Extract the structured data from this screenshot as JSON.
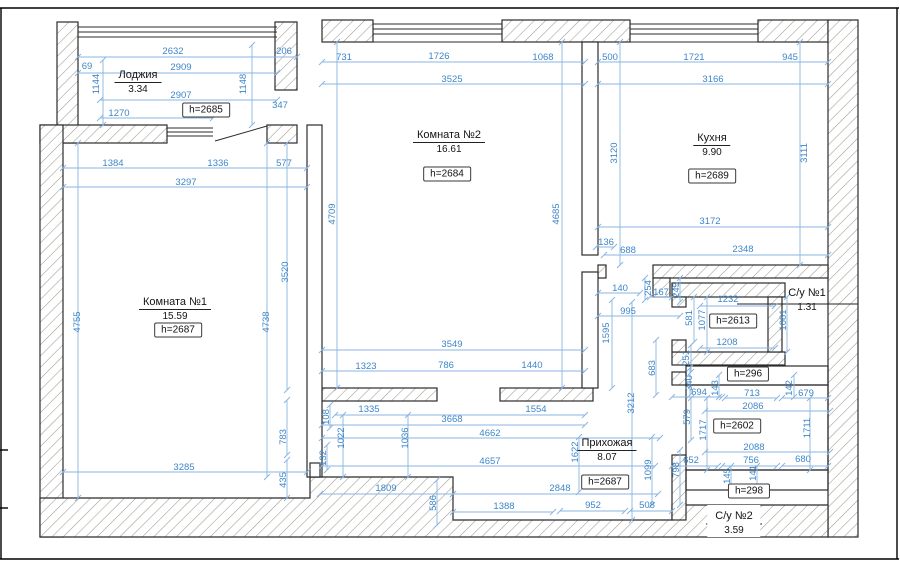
{
  "colors": {
    "dimension_text": "#3e86c8",
    "dimension_line": "#8ab5e0",
    "wall_outline": "#2b2b2b",
    "hatch_line": "#a09a90",
    "frame": "#000000"
  },
  "rooms": [
    {
      "name": "Лоджия",
      "area": "3.34"
    },
    {
      "name": "Комната №2",
      "area": "16.61"
    },
    {
      "name": "Кухня",
      "area": "9.90"
    },
    {
      "name": "Комната №1",
      "area": "15.59"
    },
    {
      "name": "Прихожая",
      "area": "8.07"
    },
    {
      "name": "С/у №1",
      "area": "1.31"
    },
    {
      "name": "С/у №2",
      "area": "3.59"
    }
  ],
  "height_boxes": [
    "h=2685",
    "h=2684",
    "h=2689",
    "h=2687",
    "h=2613",
    "h=2687",
    "h=296",
    "h=2602",
    "h=298"
  ],
  "dimensions": [
    "2632",
    "206",
    "69",
    "2909",
    "1144",
    "1148",
    "2907",
    "347",
    "1270",
    "1384",
    "1336",
    "577",
    "3297",
    "4755",
    "4738",
    "3520",
    "3285",
    "783",
    "435",
    "731",
    "1726",
    "1068",
    "3525",
    "4709",
    "4685",
    "500",
    "1721",
    "945",
    "3166",
    "3120",
    "3111",
    "3172",
    "136",
    "688",
    "2348",
    "140",
    "254",
    "167",
    "245",
    "995",
    "1595",
    "581",
    "1077",
    "1232",
    "1208",
    "1081",
    "251",
    "3212",
    "683",
    "340",
    "694",
    "143",
    "713",
    "142",
    "679",
    "2086",
    "579",
    "1717",
    "1711",
    "2088",
    "652",
    "798",
    "756",
    "680",
    "145",
    "141",
    "3549",
    "1323",
    "786",
    "1440",
    "1335",
    "1554",
    "3668",
    "4662",
    "4657",
    "108",
    "1022",
    "1036",
    "132",
    "1622",
    "1099",
    "1809",
    "586",
    "2848",
    "1388",
    "952",
    "508"
  ]
}
